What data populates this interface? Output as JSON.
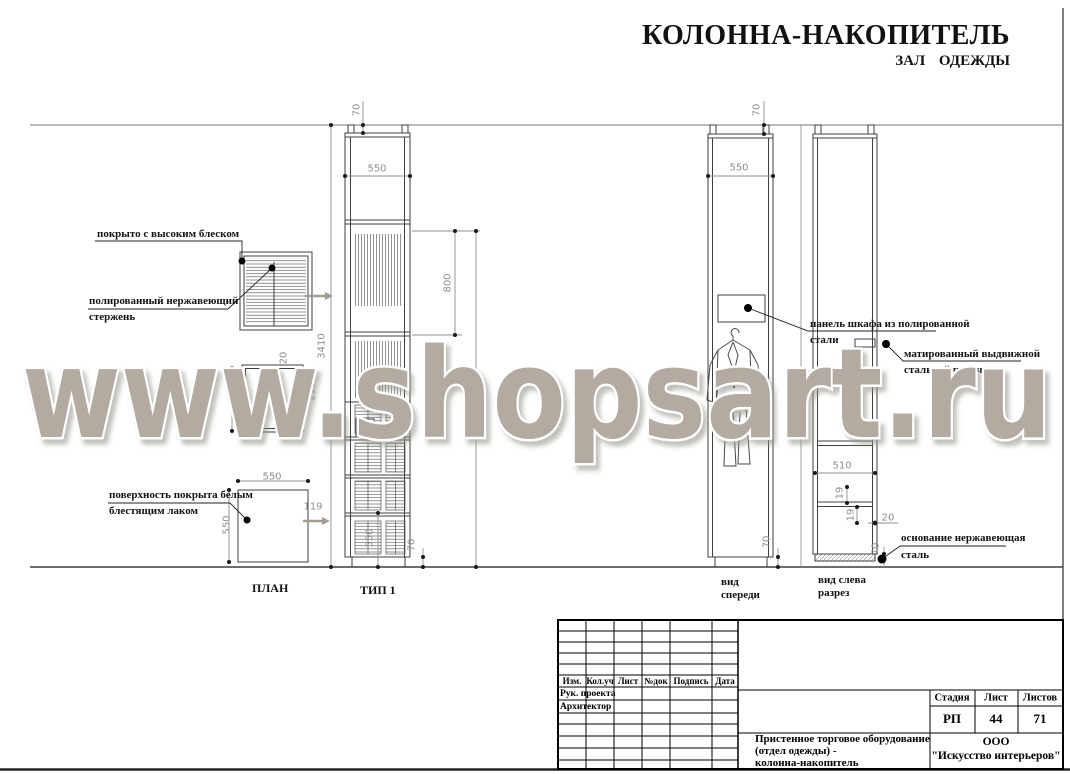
{
  "title": {
    "main": "КОЛОННА-НАКОПИТЕЛЬ",
    "sub": "ЗАЛ ОДЕЖДЫ"
  },
  "watermark": "www.shopsart.ru",
  "view_labels": {
    "plan": "ПЛАН",
    "type1": "ТИП 1",
    "front1": "вид",
    "front2": "спереди",
    "section1": "вид слева",
    "section2": "разрез"
  },
  "callouts": {
    "gloss": "покрыто с высоким блеском",
    "rod1": "полированный нержавеющий",
    "rod2": "стержень",
    "lacquer1": "поверхность покрыта белым",
    "lacquer2": "блестящим лаком",
    "panel1": "панель шкафа из полированной",
    "panel2": "стали",
    "drawer1": "матированный выдвижной",
    "drawer2": "стальной поручень",
    "base1": "основание нержавеющая",
    "base2": "сталь"
  },
  "dims": {
    "type1": {
      "mount_height": "70",
      "width": "550",
      "hanging_height": "800",
      "total_height": "3410",
      "bottom_section": "550",
      "plinth": "70"
    },
    "plan_mid": {
      "frame": "20",
      "rod_offset": "119"
    },
    "plan_bottom": {
      "width": "550",
      "depth": "550",
      "offset": "119"
    },
    "front": {
      "mount_height": "70",
      "width": "550",
      "plinth": "70"
    },
    "section": {
      "inner_width": "510",
      "gap_top": "19",
      "gap_bottom": "19",
      "edge": "20",
      "base_height": "70"
    }
  },
  "title_block": {
    "col_headers": [
      "Изм.",
      "Кол.уч",
      "Лист",
      "№док",
      "Подпись",
      "Дата"
    ],
    "roles": [
      "Рук. проекта",
      "Архитектор"
    ],
    "stage_label": "Стадия",
    "sheet_label": "Лист",
    "sheets_label": "Листов",
    "stage": "РП",
    "sheet": "44",
    "sheets": "71",
    "description": [
      "Пристенное торговое оборудование",
      "(отдел одежды) -",
      "колонна-накопитель"
    ],
    "company": [
      "ООО",
      "\"Искусство интерьеров\""
    ]
  }
}
